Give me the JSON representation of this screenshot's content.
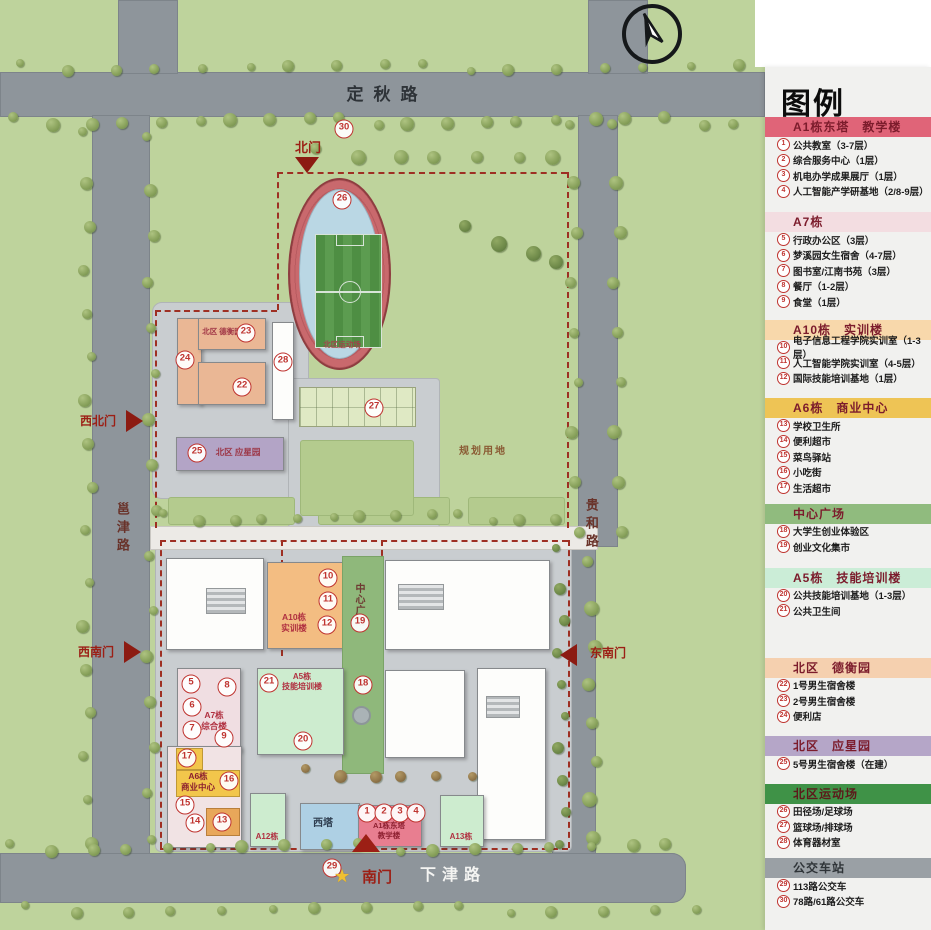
{
  "colors": {
    "boundary_dash": "#9e2f23",
    "marker_red": "#bf3430",
    "gate_red": "#8c1b12",
    "track_ring": "#c9696d",
    "field_green": "#4e8e43",
    "plaza_green": "#8fb87b",
    "dorm_peach": "#eab795",
    "yingxing_purple": "#b3a4c6",
    "a10_orange": "#f3bd82",
    "mint_green": "#cdeccf",
    "a7_pink": "#f0dee2",
    "a6_yellow": "#f2c64b",
    "a1_pink": "#e87e90",
    "xita_blue": "#aed0e4",
    "legend_bg": "#f1f1ef"
  },
  "map": {
    "roads": {
      "top": "定秋路",
      "bottom": "下津路",
      "left": "邕津路",
      "right": "贵和路"
    },
    "gates": {
      "north": "北门",
      "northwest": "西北门",
      "southwest": "西南门",
      "southeast": "东南门",
      "south": "南门"
    },
    "areas": {
      "track": "北区运动场",
      "planned": "规划用地"
    },
    "buildings": {
      "dorm_n": "北区 德衡园",
      "dorm_p": "北区 应星园",
      "a10": "A10栋\n实训楼",
      "plaza": "中心广场",
      "a5": "A5栋\n技能培训楼",
      "a7": "A7栋\n综合楼",
      "a6": "A6栋\n商业中心",
      "xita": "西塔",
      "a1": "A1栋东塔\n教学楼",
      "a12": "A12栋",
      "a13": "A13栋"
    },
    "markers": [
      {
        "n": 1,
        "x": 367,
        "y": 813
      },
      {
        "n": 2,
        "x": 384,
        "y": 813
      },
      {
        "n": 3,
        "x": 400,
        "y": 813
      },
      {
        "n": 4,
        "x": 416,
        "y": 813
      },
      {
        "n": 5,
        "x": 191,
        "y": 684
      },
      {
        "n": 6,
        "x": 192,
        "y": 707
      },
      {
        "n": 7,
        "x": 192,
        "y": 730
      },
      {
        "n": 8,
        "x": 227,
        "y": 687
      },
      {
        "n": 9,
        "x": 224,
        "y": 738
      },
      {
        "n": 10,
        "x": 328,
        "y": 578
      },
      {
        "n": 11,
        "x": 328,
        "y": 601
      },
      {
        "n": 12,
        "x": 327,
        "y": 625
      },
      {
        "n": 13,
        "x": 222,
        "y": 822
      },
      {
        "n": 14,
        "x": 195,
        "y": 823
      },
      {
        "n": 15,
        "x": 185,
        "y": 805
      },
      {
        "n": 16,
        "x": 229,
        "y": 781
      },
      {
        "n": 17,
        "x": 187,
        "y": 758
      },
      {
        "n": 18,
        "x": 363,
        "y": 685
      },
      {
        "n": 19,
        "x": 360,
        "y": 623
      },
      {
        "n": 20,
        "x": 303,
        "y": 741
      },
      {
        "n": 21,
        "x": 269,
        "y": 683
      },
      {
        "n": 22,
        "x": 242,
        "y": 387
      },
      {
        "n": 23,
        "x": 246,
        "y": 333
      },
      {
        "n": 24,
        "x": 185,
        "y": 360
      },
      {
        "n": 25,
        "x": 197,
        "y": 453
      },
      {
        "n": 26,
        "x": 342,
        "y": 200
      },
      {
        "n": 27,
        "x": 374,
        "y": 408
      },
      {
        "n": 28,
        "x": 283,
        "y": 362
      },
      {
        "n": 29,
        "x": 332,
        "y": 868
      },
      {
        "n": 30,
        "x": 344,
        "y": 129
      }
    ]
  },
  "legend": {
    "title": "图例",
    "sections": [
      {
        "header": "A1栋东塔　教学楼",
        "color": "#e06478",
        "text_color": "#7c1c2c",
        "items": [
          {
            "n": 1,
            "label": "公共教室（3-7层）"
          },
          {
            "n": 2,
            "label": "综合服务中心（1层）"
          },
          {
            "n": 3,
            "label": "机电办学成果展厅（1层）"
          },
          {
            "n": 4,
            "label": "人工智能产学研基地（2/8-9层）"
          }
        ]
      },
      {
        "header": "A7栋",
        "color": "#f3dde1",
        "text_color": "#7c1c2c",
        "items": [
          {
            "n": 5,
            "label": "行政办公区（3层）"
          },
          {
            "n": 6,
            "label": "梦溪园女生宿舍（4-7层）"
          },
          {
            "n": 7,
            "label": "图书室/江南书苑（3层）"
          },
          {
            "n": 8,
            "label": "餐厅（1-2层）"
          },
          {
            "n": 9,
            "label": "食堂（1层）"
          }
        ]
      },
      {
        "header": "A10栋　实训楼",
        "color": "#f8d8ab",
        "text_color": "#7c1c2c",
        "items": [
          {
            "n": 10,
            "label": "电子信息工程学院实训室（1-3层）"
          },
          {
            "n": 11,
            "label": "人工智能学院实训室（4-5层）"
          },
          {
            "n": 12,
            "label": "国际技能培训基地（1层）"
          }
        ]
      },
      {
        "header": "A6栋　商业中心",
        "color": "#eec455",
        "text_color": "#7c1c2c",
        "items": [
          {
            "n": 13,
            "label": "学校卫生所"
          },
          {
            "n": 14,
            "label": "便利超市"
          },
          {
            "n": 15,
            "label": "菜鸟驿站"
          },
          {
            "n": 16,
            "label": "小吃街"
          },
          {
            "n": 17,
            "label": "生活超市"
          }
        ]
      },
      {
        "header": "中心广场",
        "color": "#90bb7e",
        "text_color": "#7c1c2c",
        "items": [
          {
            "n": 18,
            "label": "大学生创业体验区"
          },
          {
            "n": 19,
            "label": "创业文化集市"
          }
        ]
      },
      {
        "header": "A5栋　技能培训楼",
        "color": "#cbedd7",
        "text_color": "#7c1c2c",
        "items": [
          {
            "n": 20,
            "label": "公共技能培训基地（1-3层）"
          },
          {
            "n": 21,
            "label": "公共卫生间"
          }
        ]
      },
      {
        "header": "北区　德衡园",
        "color": "#f5d0af",
        "text_color": "#7c1c2c",
        "items": [
          {
            "n": 22,
            "label": "1号男生宿舍楼"
          },
          {
            "n": 23,
            "label": "2号男生宿舍楼"
          },
          {
            "n": 24,
            "label": "便利店"
          }
        ]
      },
      {
        "header": "北区　应星园",
        "color": "#b5a6c8",
        "text_color": "#7c1c2c",
        "items": [
          {
            "n": 25,
            "label": "5号男生宿舍楼（在建）"
          }
        ]
      },
      {
        "header": "北区运动场",
        "color": "#3f9247",
        "text_color": "#5c1a1a",
        "items": [
          {
            "n": 26,
            "label": "田径场/足球场"
          },
          {
            "n": 27,
            "label": "篮球场/排球场"
          },
          {
            "n": 28,
            "label": "体育器材室"
          }
        ]
      },
      {
        "header": "公交车站",
        "color": "#9aa0a5",
        "text_color": "#2f3438",
        "items": [
          {
            "n": 29,
            "label": "113路公交车"
          },
          {
            "n": 30,
            "label": "78路/61路公交车"
          }
        ]
      }
    ]
  }
}
